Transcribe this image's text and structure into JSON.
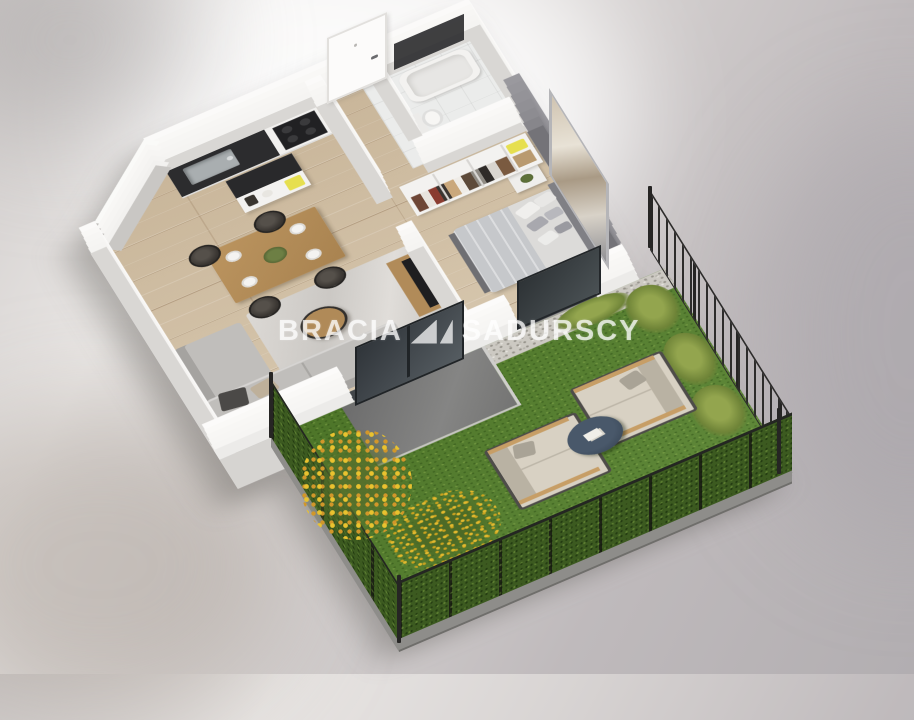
{
  "watermark": {
    "left": "BRACIA",
    "right": "SADURSCY"
  },
  "scene": {
    "type": "isometric-3d-floor-plan-render",
    "areas": [
      "kitchen",
      "dining-area",
      "living-area",
      "hallway",
      "bathroom",
      "bedroom",
      "wardrobe",
      "terrace",
      "garden"
    ],
    "objects": [
      "kitchen-counter",
      "sink",
      "cooktop",
      "kitchen-island",
      "dining-table",
      "wicker-chairs",
      "corner-sofa",
      "rug",
      "coffee-table",
      "tv-console",
      "entry-door",
      "bathtub",
      "toilet",
      "open-wardrobe",
      "double-bed",
      "nightstand",
      "wall-artwork",
      "sliding-glass-door",
      "terrace-slab",
      "gravel-strip",
      "lawn",
      "hedge-fence",
      "metal-fence",
      "outdoor-loveseats",
      "garden-coffee-table",
      "flower-beds",
      "ornamental-grasses"
    ]
  },
  "palette": {
    "background_light": "#e9e6e4",
    "background_dark": "#b2aeb1",
    "wall_white": "#f7f6f4",
    "wall_inner_gray": "#d9d7d4",
    "accent_wall_gray": "#97969b",
    "wood_floor": "#cfbda3",
    "bath_floor": "#ebeceb",
    "countertop_black": "#2b2b2d",
    "table_wood": "#b18a58",
    "sofa_gray": "#b6b4b1",
    "bed_linen": "#dcdbd9",
    "lawn_green": "#55812c",
    "hedge_green": "#3c5a20",
    "terrace_gray": "#757575",
    "fence_black": "#2d2c2b",
    "garden_table_navy": "#3c4a59",
    "accent_yellow": "#e6df4f",
    "flower_yellow": "#e3b92e",
    "watermark_white": "rgba(255,255,255,0.72)"
  }
}
